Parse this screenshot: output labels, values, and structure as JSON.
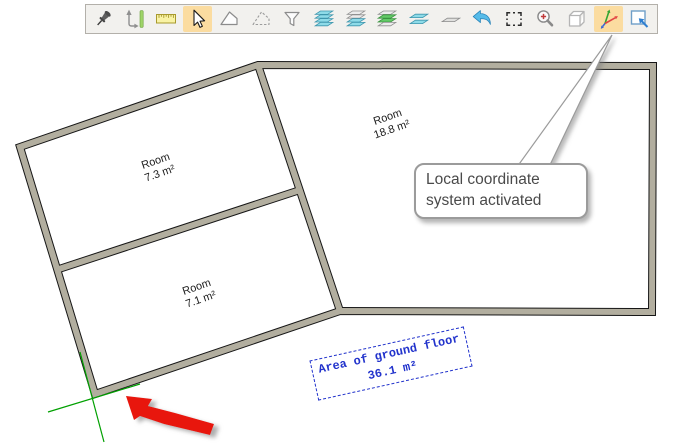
{
  "toolbar": {
    "highlight_color": "#fbdca0",
    "items": [
      {
        "name": "pin",
        "selected": false
      },
      {
        "name": "measure-edge",
        "selected": false
      },
      {
        "name": "ruler",
        "selected": false
      },
      {
        "name": "select-cursor",
        "selected": true
      },
      {
        "name": "polygon",
        "selected": false
      },
      {
        "name": "polygon-auxiliary",
        "selected": false
      },
      {
        "name": "filter",
        "selected": false
      },
      {
        "name": "layers-stack",
        "selected": false
      },
      {
        "name": "layers-upper",
        "selected": false
      },
      {
        "name": "layers-current-green",
        "selected": false
      },
      {
        "name": "layers-thin-pair",
        "selected": false
      },
      {
        "name": "layer-single",
        "selected": false
      },
      {
        "name": "undo",
        "selected": false
      },
      {
        "name": "select-area",
        "selected": false
      },
      {
        "name": "zoom-in",
        "selected": false
      },
      {
        "name": "solid-box",
        "selected": false
      },
      {
        "name": "local-coordinate-system",
        "selected": true
      },
      {
        "name": "new-view",
        "selected": false
      }
    ]
  },
  "callout": {
    "text": "Local coordinate system activated"
  },
  "rooms": [
    {
      "name": "Room",
      "area": "7.3 m²"
    },
    {
      "name": "Room",
      "area": "18.8 m²"
    },
    {
      "name": "Room",
      "area": "7.1 m²"
    }
  ],
  "area_label": {
    "title": "Area of ground floor",
    "value": "36.1 m²"
  },
  "colors": {
    "wall_fill": "#b2ae9f",
    "wall_outline": "#161616",
    "axis_green": "#00a000",
    "arrow_red": "#e8150b",
    "label_blue": "#2233cc",
    "toolbar_bg": "#f2f1ee"
  }
}
